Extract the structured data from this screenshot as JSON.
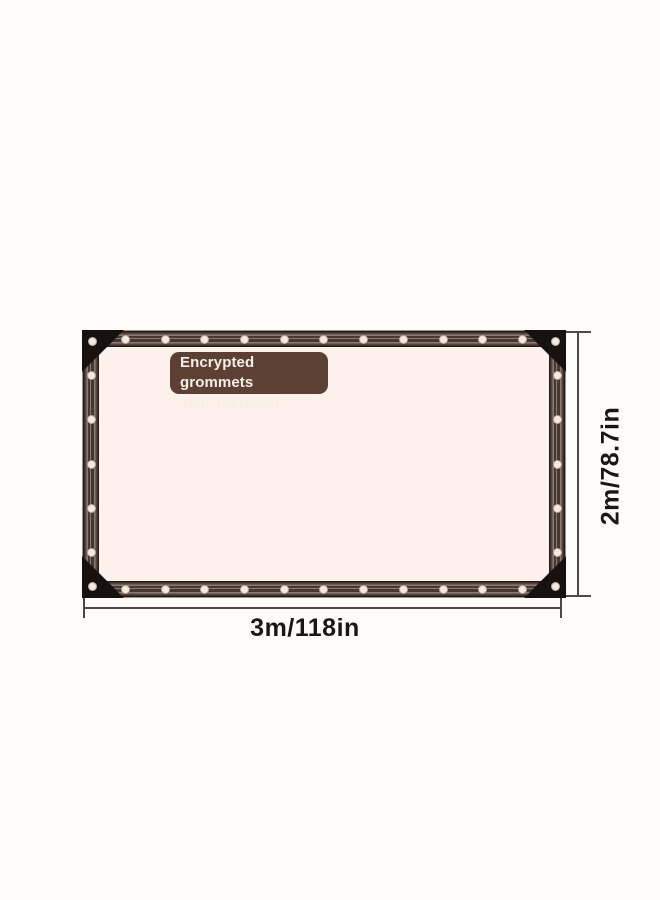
{
  "product_diagram": {
    "feature_label": {
      "line1": "Encrypted grommets",
      "line2": "Tear-resistant"
    },
    "dimensions": {
      "width_label": "3m/118in",
      "height_label": "2m/78.7in"
    },
    "grommets": {
      "top": 11,
      "bottom": 11,
      "left": 5,
      "right": 5,
      "corners": 4
    }
  },
  "colors": {
    "background": "#fdfcfa",
    "tarp_fill": "#fcf1ec",
    "strip_dark": "#241b17",
    "strip_mid": "#55453e",
    "strip_deep": "#463832",
    "strip_light": "#8d7a70",
    "grommet": "#f6e9e0",
    "corner_patch": "#17120f",
    "label_bg": "#5d4034",
    "label_text": "#f8efe8",
    "dim_line": "#4c4a46",
    "dim_text": "#181714"
  }
}
